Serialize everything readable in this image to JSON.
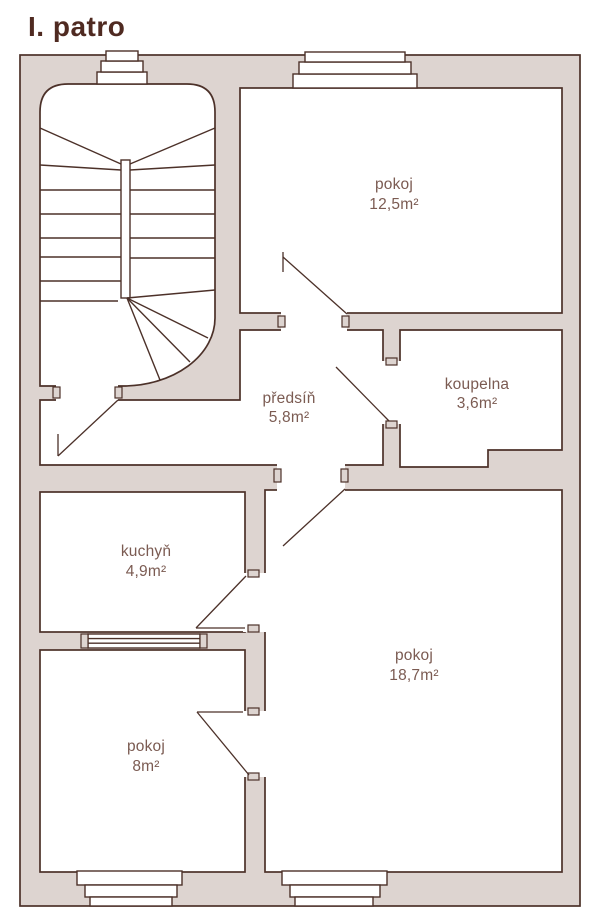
{
  "title": "I. patro",
  "colors": {
    "wall_fill": "#ddd4d0",
    "line": "#4c3129",
    "label_text": "#7b5b52",
    "title_text": "#4f2a21",
    "background": "#ffffff"
  },
  "rooms": [
    {
      "id": "pokoj-12-5",
      "name": "pokoj",
      "area": "12,5m²"
    },
    {
      "id": "koupelna",
      "name": "koupelna",
      "area": "3,6m²"
    },
    {
      "id": "predsin",
      "name": "předsíň",
      "area": "5,8m²"
    },
    {
      "id": "kuchyn",
      "name": "kuchyň",
      "area": "4,9m²"
    },
    {
      "id": "pokoj-18-7",
      "name": "pokoj",
      "area": "18,7m²"
    },
    {
      "id": "pokoj-8",
      "name": "pokoj",
      "area": "8m²"
    }
  ]
}
